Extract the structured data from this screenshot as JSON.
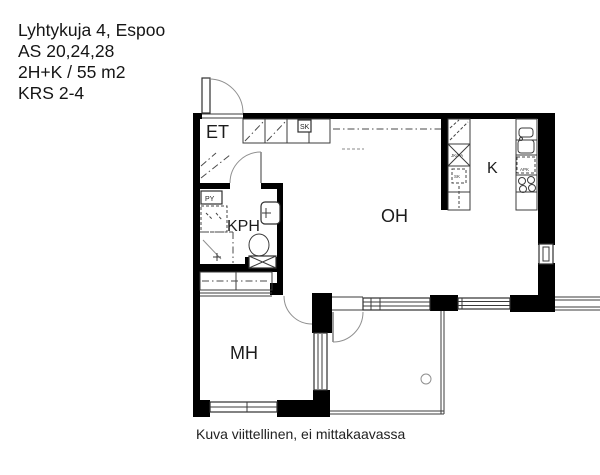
{
  "header": {
    "lines": [
      "Lyhtykuja 4, Espoo",
      "AS 20,24,28",
      "2H+K / 55 m2",
      "KRS 2-4"
    ]
  },
  "plan": {
    "room_labels": {
      "entry": "ET",
      "bathroom": "KPH",
      "living_room": "OH",
      "kitchen": "K",
      "bedroom": "MH"
    },
    "fixture_labels": {
      "washing_machine": "PY",
      "hall_cabinet": "SK",
      "fridge_freezer": "JK/PA",
      "cleaning_cabinet": "SK",
      "dishwasher": "APK"
    }
  },
  "footer": {
    "caption": "Kuva viittellinen, ei mittakaavassa"
  },
  "colors": {
    "wall": "#000000",
    "line": "#3b3b3b",
    "arc": "#8f8f8f",
    "background": "#ffffff"
  }
}
